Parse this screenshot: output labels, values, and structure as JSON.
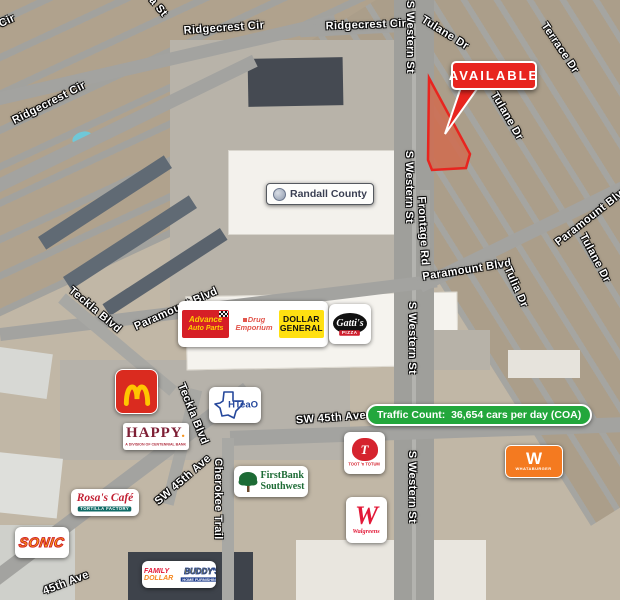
{
  "colors": {
    "available_red": "#e8251f",
    "parcel_fill": "rgba(211,104,74,0.8)",
    "traffic_green": "#23a73c",
    "mcdonalds_red": "#da2b1f",
    "arches_yellow": "#ffc600",
    "dollar_yellow": "#ffe011",
    "advance_red": "#d61f26",
    "whataburger_orange": "#f47a20",
    "happy_maroon": "#7e1f35",
    "walgreens_red": "#e31837",
    "sonic_yellow": "#ffca05",
    "sonic_red": "#d2232a",
    "firstbank_green": "#1d6b35",
    "hteao_navy": "#26489c",
    "rosas_red": "#c22033",
    "buddys_navy": "#1b3a8c",
    "buddys_yellow": "#ffd400",
    "tootn_red": "#d5232e",
    "gattis_red": "#cf1f2e",
    "randall_text": "#3a3f52"
  },
  "parcel": {
    "outline": "429,78 470,154 466,168 432,170 428,160",
    "callout_tail": "461,87 477,89 445,134"
  },
  "street_labels": [
    {
      "text": "Cir",
      "x": 7,
      "y": 21,
      "rot": -25
    },
    {
      "text": "a St",
      "x": 158,
      "y": 7,
      "rot": 50
    },
    {
      "text": "Ridgecrest Cir",
      "x": 224,
      "y": 28,
      "rot": -4
    },
    {
      "text": "Ridgecrest Cir",
      "x": 366,
      "y": 25,
      "rot": -2
    },
    {
      "text": "S Western St",
      "x": 410,
      "y": 37,
      "rot": 90
    },
    {
      "text": "Tulane Dr",
      "x": 445,
      "y": 33,
      "rot": 32
    },
    {
      "text": "Terrace Dr",
      "x": 560,
      "y": 48,
      "rot": 56
    },
    {
      "text": "Ridgecrest Cir",
      "x": 49,
      "y": 103,
      "rot": -27
    },
    {
      "text": "Tulane Dr",
      "x": 507,
      "y": 116,
      "rot": 60
    },
    {
      "text": "S Western St",
      "x": 409,
      "y": 187,
      "rot": 90
    },
    {
      "text": "Frontage Rd",
      "x": 423,
      "y": 231,
      "rot": 87
    },
    {
      "text": "Paramount Blvd",
      "x": 592,
      "y": 216,
      "rot": -38
    },
    {
      "text": "Tulane Dr",
      "x": 595,
      "y": 258,
      "rot": 62
    },
    {
      "text": "Paramount Blvd",
      "x": 467,
      "y": 270,
      "rot": -9
    },
    {
      "text": "Tulia Dr",
      "x": 516,
      "y": 287,
      "rot": 66
    },
    {
      "text": "Teckla Blvd",
      "x": 95,
      "y": 310,
      "rot": 40
    },
    {
      "text": "Paramount Blvd",
      "x": 176,
      "y": 309,
      "rot": -24
    },
    {
      "text": "S Western St",
      "x": 412,
      "y": 338,
      "rot": 90
    },
    {
      "text": "Teckla Blvd",
      "x": 193,
      "y": 414,
      "rot": 68
    },
    {
      "text": "SW 45th Ave",
      "x": 331,
      "y": 418,
      "rot": -4
    },
    {
      "text": "SW 45th Ave",
      "x": 183,
      "y": 480,
      "rot": -41
    },
    {
      "text": "Cherokee Trail",
      "x": 218,
      "y": 499,
      "rot": 90
    },
    {
      "text": "S Western St",
      "x": 412,
      "y": 487,
      "rot": 90
    },
    {
      "text": "45th Ave",
      "x": 66,
      "y": 583,
      "rot": -21
    }
  ],
  "pois": {
    "available": "AVAILABLE",
    "traffic_badge": "Traffic Count:  36,654 cars per day (COA)",
    "randall_county": "Randall County",
    "advance": {
      "line1": "Advance",
      "line2": "Auto Parts"
    },
    "drug_emporium": {
      "line1": "Drug",
      "line2": "Emporium"
    },
    "dollar_general": {
      "line1": "DOLLAR",
      "line2": "GENERAL"
    },
    "gattis": {
      "name": "Gatti's",
      "sub": "PIZZA"
    },
    "mcdonalds": {
      "icon": "golden-arches"
    },
    "happy": {
      "name": "HAPPY",
      "dot": ".",
      "tagline": "A DIVISION OF CENTENNIAL BANK"
    },
    "hteao": {
      "name": "HTeaO",
      "icon": "texas-outline"
    },
    "sonic": {
      "name": "SONIC"
    },
    "rosas": {
      "name": "Rosa's Café",
      "tagline": "TORTILLA FACTORY"
    },
    "firstbank": {
      "line1": "FirstBank",
      "line2": "Southwest",
      "icon": "tree"
    },
    "tootn": {
      "initial": "T",
      "name": "TOOT 'n TOTUM"
    },
    "walgreens": {
      "initial": "W",
      "name": "Walgreens"
    },
    "whataburger": {
      "initial": "W",
      "name": "WHATABURGER"
    },
    "family_dollar": {
      "line1": "FAMILY",
      "line2": "DOLLAR"
    },
    "buddys": {
      "name": "BUDDY'S",
      "tagline": "HOME FURNISHINGS"
    }
  }
}
